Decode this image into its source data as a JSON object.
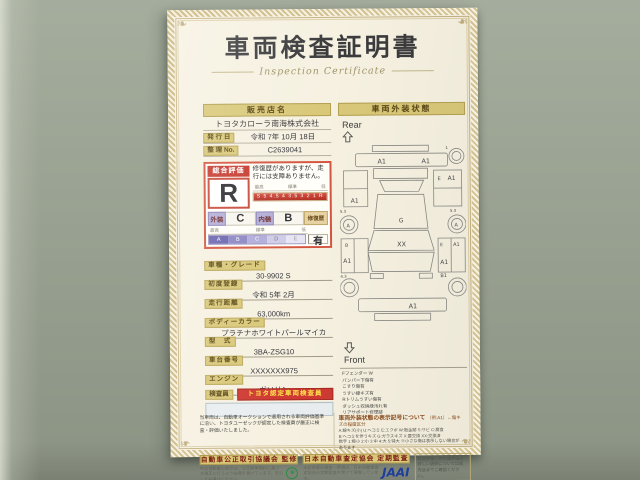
{
  "doc": {
    "title": "車両検査証明書",
    "subtitle": "Inspection Certificate",
    "left": {
      "dealer_header": "販売店名",
      "dealer_name": "トヨタカローラ南海株式会社",
      "issue_label": "発 行 日",
      "issue_value": "令和 7年 10月 18日",
      "ref_label": "整 理 No.",
      "ref_value": "C2639041",
      "eval": {
        "header": "総合評価",
        "grade": "R",
        "note": "修復歴がありますが、走行には支障ありません。",
        "scale_high": "最高",
        "scale_mid": "標準",
        "scale_low": "低",
        "scale_marks": "S 5 4.5 4 3.5 3 2 1 R",
        "ext_label": "外装",
        "ext_value": "C",
        "int_label": "内装",
        "int_value": "B",
        "repair_label": "修復歴",
        "repair_value": "有",
        "sub_high": "最高",
        "sub_mid": "標準",
        "sub_low": "低",
        "sub_scale": [
          "A",
          "B",
          "C",
          "D",
          "E"
        ]
      },
      "fields": [
        {
          "label": "車種・グレード",
          "value": "30-9902 S"
        },
        {
          "label": "初度登録",
          "value": "令和 5年 2月"
        },
        {
          "label": "走行距離",
          "value": "63,000km"
        },
        {
          "label": "ボディーカラー",
          "value": "プラチナホワイトパールマイカ"
        },
        {
          "label": "型　式",
          "value": "3BA-ZSG10"
        },
        {
          "label": "車台番号",
          "value": "XXXXXXX975"
        },
        {
          "label": "エンジン",
          "value": "ガソリン"
        }
      ],
      "inspector_label": "検査員",
      "inspector_badge": "トヨタ認定車両検査員"
    },
    "right": {
      "header": "車両外装状態",
      "rear_label": "Rear",
      "front_label": "Front",
      "marks": {
        "rear_bumper_l": "A1",
        "rear_bumper_r": "A1",
        "tail_code": "1",
        "left_quarter": "A1",
        "right_quarter_e": "E",
        "right_quarter": "A1",
        "wheel_rear_l": "A",
        "wheel_rear_r": "A",
        "left_door_b": "B",
        "left_door": "A1",
        "right_door_e": "E",
        "right_door_top": "A1",
        "right_door": "A1",
        "roof": "G",
        "windshield": "XX",
        "front_fender_r": "B1",
        "front_bumper": "A1",
        "code_tl": "5.3",
        "code_tr": "5.3",
        "code_bl": "4.3"
      },
      "legend": [
        "Fフェンダー W",
        "バンパー下傷有",
        "こすり傷有",
        "うすい線キズ有",
        "Rトリムうすい傷有",
        "ダッシュ収納縁汚れ有",
        "リアサポート修理跡"
      ]
    },
    "bottom": {
      "note_left": "当車両は、自動車オークションで適用される車両評価基準に沿い、トヨタユーゼックが認定した検査員が厳正に検査・評価いたしました。",
      "symbols_header": "車両外装状態の表示記号について",
      "symbols_example": "（例:A1）←傷キズの程度区分",
      "symbols_lines": [
        "A:線キズ(小) U:ヘコミ E:エクボ W:板金跡 S:サビ C:腐食",
        "B:ヘコミを伴うキズ G:ガラスキズ X:要交換 XX:交換済",
        "数字 1:極小 2:小 3:中 4:大 5:特大 ※小さな傷は表示しない場合があります"
      ],
      "banner_left": "自動車公正取引協議会 監修",
      "banner_left_sub": "中古自動車の表示は、公正競争規約に基づき適正に行うよう指導を受けています。安心してお選びください。",
      "banner_right": "日本自動車査定協会 定期監査",
      "banner_right_sub": "本証明書の検査・評価は、日本自動車査定協会の定期監査を受けて実施しています。",
      "jaai_logo": "JAAI",
      "side_note": "総合評価、内外装評価の詳しい説明については販売店までご確認ください。"
    }
  }
}
